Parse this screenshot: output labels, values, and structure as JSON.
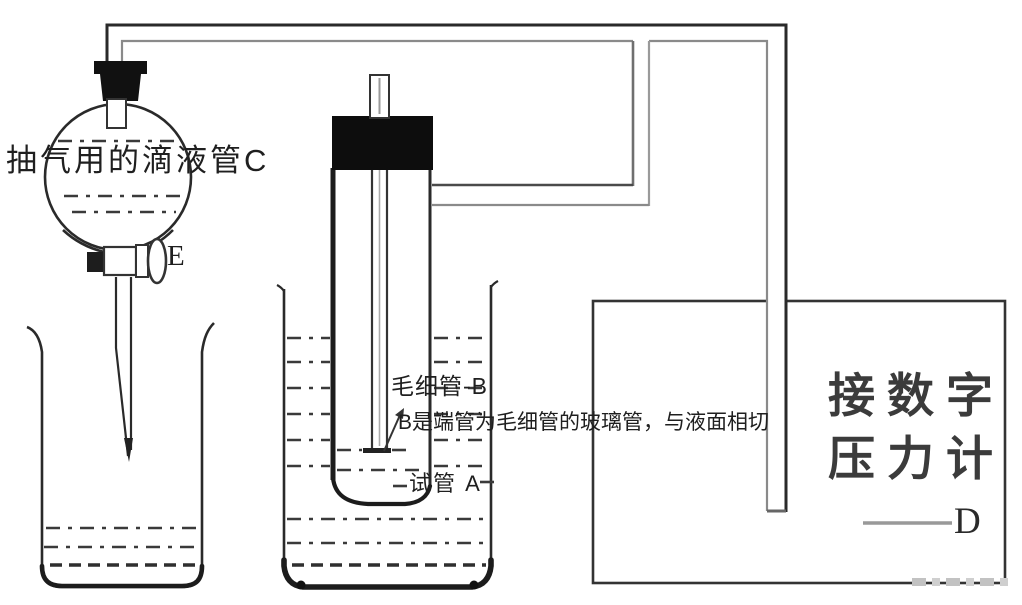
{
  "labels": {
    "funnel": "抽气用的滴液管C",
    "stopcock": "E",
    "capillary": "毛细管-B",
    "capillary_note": "B是端管为毛细管的玻璃管，与液面相切",
    "test_tube": "试管 A",
    "gauge_line1": "接数字",
    "gauge_line2": "压力计",
    "gauge_connector": "D"
  },
  "colors": {
    "ink": "#2a2a2a",
    "inner_tube_gray": "#8a8a8a",
    "stopper_black": "#111111",
    "label_text": "#1f1f1f",
    "gauge_text": "#3b3b3b",
    "gauge_dash_gray": "#999999",
    "watermark_gray": "#c2c2c2",
    "background": "#ffffff"
  }
}
